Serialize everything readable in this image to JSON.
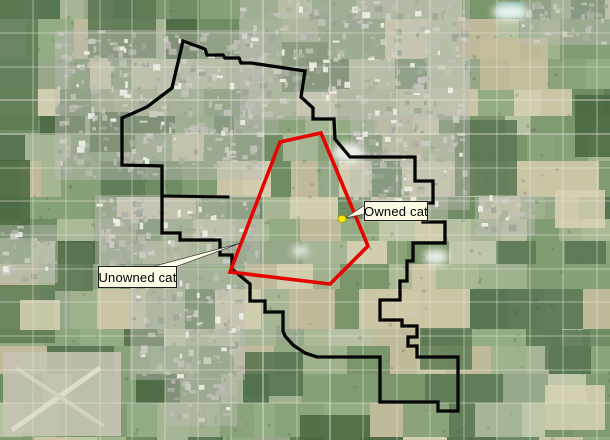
{
  "map": {
    "labels": {
      "owned": {
        "text": "Owned cat",
        "box": {
          "x": 364,
          "y": 201,
          "w": 64,
          "h": 20
        }
      },
      "unowned": {
        "text": "Unowned cat",
        "box": {
          "x": 98,
          "y": 266,
          "w": 79,
          "h": 22
        }
      }
    },
    "markers": {
      "owned_cat": {
        "x": 342,
        "y": 219,
        "rx": 4.2,
        "ry": 3.6,
        "fill": "#f2e60a",
        "stroke": "#a29a00"
      }
    },
    "callout_pointers": {
      "owned": [
        [
          345,
          218
        ],
        [
          365,
          205
        ],
        [
          365,
          214
        ]
      ],
      "unowned": [
        [
          241,
          243
        ],
        [
          151,
          267
        ],
        [
          175,
          267
        ]
      ]
    },
    "overlays": {
      "city_boundary": {
        "color": "#050505",
        "stroke_width": 3.3,
        "closed": true,
        "points": [
          [
            183,
            41
          ],
          [
            205,
            49
          ],
          [
            207,
            55
          ],
          [
            223,
            55
          ],
          [
            225,
            58
          ],
          [
            239,
            58
          ],
          [
            241,
            63
          ],
          [
            251,
            63
          ],
          [
            305,
            71
          ],
          [
            301,
            97
          ],
          [
            313,
            108
          ],
          [
            313,
            119
          ],
          [
            334,
            119
          ],
          [
            335,
            139
          ],
          [
            350,
            157
          ],
          [
            415,
            157
          ],
          [
            415,
            181
          ],
          [
            433,
            181
          ],
          [
            433,
            203
          ],
          [
            423,
            203
          ],
          [
            423,
            222
          ],
          [
            445,
            222
          ],
          [
            445,
            243
          ],
          [
            413,
            243
          ],
          [
            413,
            261
          ],
          [
            407,
            261
          ],
          [
            407,
            281
          ],
          [
            400,
            281
          ],
          [
            400,
            300
          ],
          [
            380,
            300
          ],
          [
            380,
            320
          ],
          [
            402,
            320
          ],
          [
            402,
            326
          ],
          [
            417,
            326
          ],
          [
            417,
            337
          ],
          [
            408,
            337
          ],
          [
            408,
            346
          ],
          [
            417,
            346
          ],
          [
            417,
            357
          ],
          [
            458,
            357
          ],
          [
            458,
            411
          ],
          [
            438,
            411
          ],
          [
            438,
            402
          ],
          [
            380,
            402
          ],
          [
            380,
            357
          ],
          [
            317,
            357
          ],
          [
            305,
            353
          ],
          [
            293,
            345
          ],
          [
            285,
            336
          ],
          [
            283,
            331
          ],
          [
            283,
            312
          ],
          [
            265,
            312
          ],
          [
            265,
            301
          ],
          [
            250,
            301
          ],
          [
            250,
            284
          ],
          [
            232,
            269
          ],
          [
            232,
            255
          ],
          [
            220,
            255
          ],
          [
            220,
            240
          ],
          [
            180,
            240
          ],
          [
            180,
            233
          ],
          [
            162,
            233
          ],
          [
            162,
            166
          ],
          [
            122,
            165
          ],
          [
            122,
            118
          ],
          [
            147,
            107
          ],
          [
            172,
            88
          ]
        ]
      },
      "city_boundary_spur": {
        "color": "#050505",
        "stroke_width": 3.0,
        "closed": false,
        "points": [
          [
            163,
            196
          ],
          [
            228,
            197
          ]
        ]
      },
      "study_area": {
        "color": "#e60400",
        "stroke_width": 3.6,
        "closed": true,
        "points": [
          [
            280,
            142
          ],
          [
            321,
            133
          ],
          [
            368,
            246
          ],
          [
            330,
            284
          ],
          [
            230,
            272
          ]
        ]
      }
    },
    "label_style": {
      "bg": "#fcfae5",
      "border": "#1c1c1c"
    }
  }
}
